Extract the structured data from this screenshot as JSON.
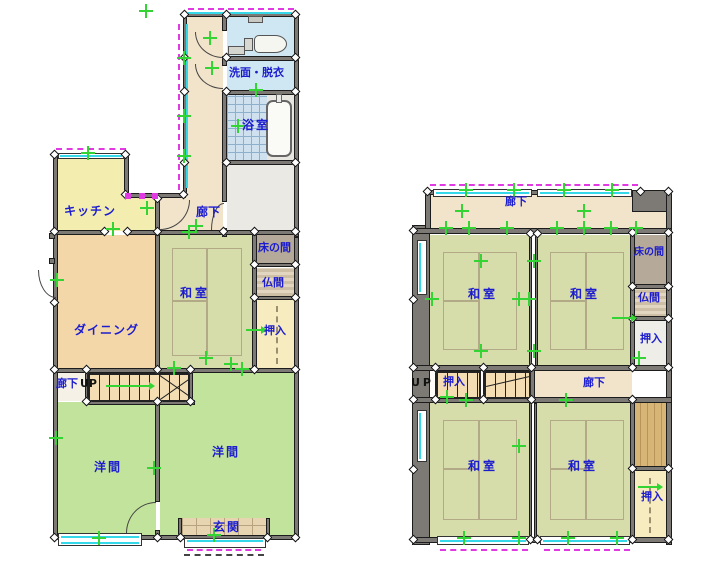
{
  "floor1": {
    "washroom_label": "洗面・脱衣",
    "bath_label": "浴室",
    "kitchen_label": "キッチン",
    "hallway_label": "廊下",
    "dining_label": "ダイニング",
    "washitsu_label": "和室",
    "tokonoma_label": "床の間",
    "butsuma_label": "仏間",
    "oshiire_label": "押入",
    "stair_hallway_label": "廊下",
    "stair_up_label": "UP",
    "western_left_label": "洋間",
    "western_right_label": "洋間",
    "entrance_label": "玄関"
  },
  "floor2": {
    "hallway_top_label": "廊下",
    "washitsu_nw_label": "和室",
    "washitsu_ne_label": "和室",
    "tokonoma_label": "床の間",
    "butsuma_label": "仏間",
    "oshiire_right_label": "押入",
    "stair_up_label": "UP",
    "oshiire_stair_label": "押入",
    "hallway_mid_label": "廊下",
    "washitsu_sw_label": "和室",
    "washitsu_se_label": "和室",
    "oshiire_se_label": "押入"
  },
  "colors": {
    "label_text": "#1c1ccf",
    "tatami": "#d6dcaa",
    "wood_floor_room": "#c2e39b",
    "dining": "#f4d7a9",
    "kitchen": "#f3eeb0",
    "hallway": "#f2e4cb",
    "water_room": "#cfe7f2",
    "closet": "#f7ecc0",
    "tokonoma": "#b5aa99",
    "wall": "#7d7974",
    "marker_green": "#35d435",
    "window_cyan": "#35d8e8",
    "sliding_door_magenta": "#e23ae2"
  }
}
